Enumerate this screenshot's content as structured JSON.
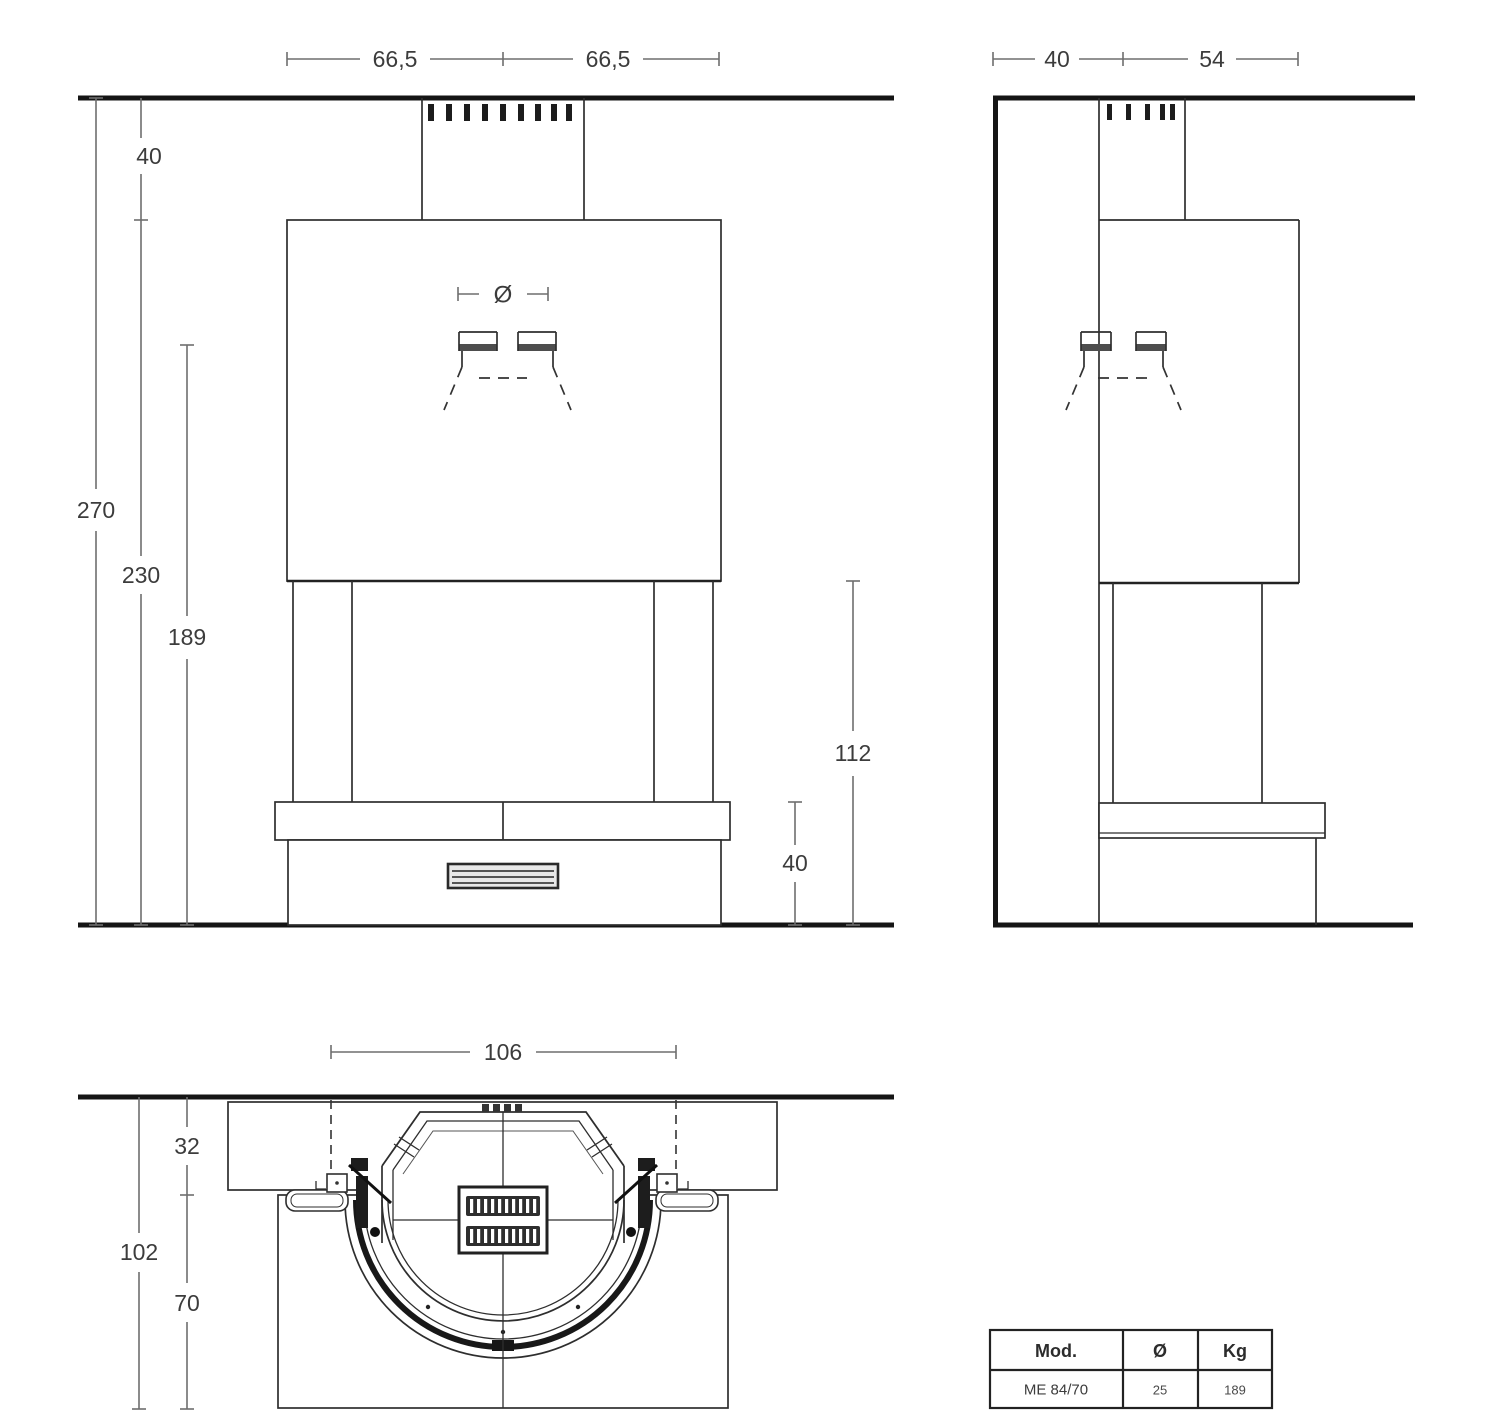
{
  "drawing_type": "fireplace installation dimensional drawing",
  "front_view": {
    "dims": {
      "top_left_width": "66,5",
      "top_right_width": "66,5",
      "ceiling_to_hood": "40",
      "total_height": "270",
      "hood_to_floor": "230",
      "flue_connection_height": "189",
      "opening_height": "112",
      "base_height": "40",
      "flue_diameter_symbol": "Ø"
    }
  },
  "side_view": {
    "dims": {
      "wall_to_flue": "40",
      "flue_to_front": "54"
    }
  },
  "plan_view": {
    "dims": {
      "front_width": "106",
      "shelf_depth": "32",
      "total_depth": "102",
      "hearth_depth": "70"
    }
  },
  "spec_table": {
    "headers": {
      "model": "Mod.",
      "diameter": "Ø",
      "weight": "Kg"
    },
    "rows": [
      {
        "model": "ME 84/70",
        "diameter": "25",
        "weight": "189"
      }
    ]
  },
  "colors": {
    "line": "#2e2e2e",
    "heavy_line": "#151515",
    "dimension_line": "#6e6e6e",
    "text": "#3c3c3c",
    "background": "#ffffff"
  }
}
